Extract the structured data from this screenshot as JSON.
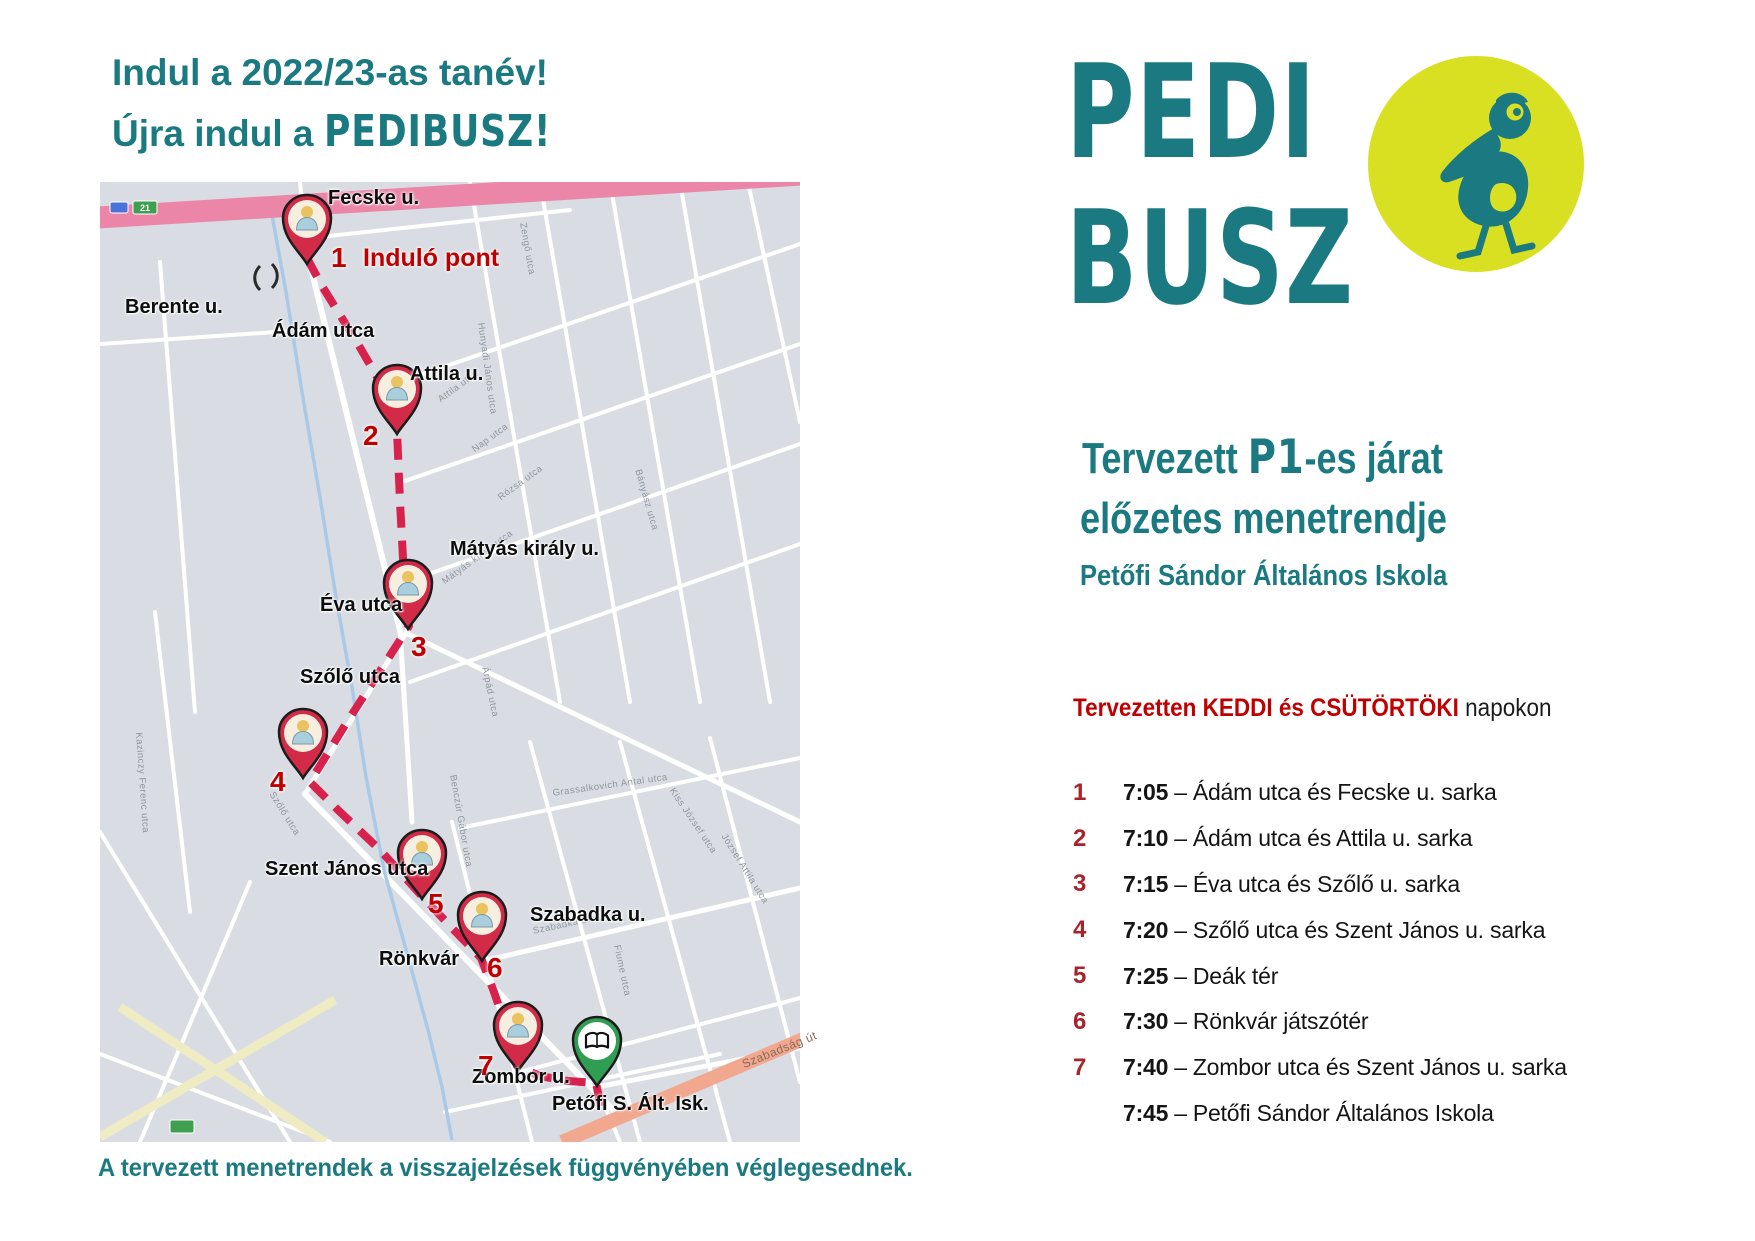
{
  "poster_title": {
    "line1": "Indul a 2022/23-as tanév!",
    "line2_prefix": "Újra indul a ",
    "line2_brand": "PEDIBUSZ!"
  },
  "logo": {
    "word1": "PEDI",
    "word2": "BUSZ",
    "badge_icon": "pelican-icon",
    "badge_bg": "#d9e021"
  },
  "plan": {
    "heading_pre": "Tervezett ",
    "heading_route": "P1",
    "heading_post": "-es járat",
    "heading_line2": "előzetes menetrendje",
    "school": "Petőfi Sándor Általános Iskola",
    "days_highlight": "Tervezetten KEDDI és CSÜTÖRTÖKI",
    "days_rest": " napokon"
  },
  "schedule": [
    {
      "n": "1",
      "time": "7:05",
      "place": "Ádám utca és Fecske u. sarka"
    },
    {
      "n": "2",
      "time": "7:10",
      "place": "Ádám utca és Attila u. sarka"
    },
    {
      "n": "3",
      "time": "7:15",
      "place": "Éva utca és Szőlő u. sarka"
    },
    {
      "n": "4",
      "time": "7:20",
      "place": "Szőlő utca és Szent János u. sarka"
    },
    {
      "n": "5",
      "time": "7:25",
      "place": "Deák tér"
    },
    {
      "n": "6",
      "time": "7:30",
      "place": "Rönkvár játszótér"
    },
    {
      "n": "7",
      "time": "7:40",
      "place": "Zombor utca és Szent János u. sarka"
    },
    {
      "n": "",
      "time": "7:45",
      "place": "Petőfi Sándor Általános Iskola"
    }
  ],
  "footer": "A tervezett menetrendek a visszajelzések függvényében véglegesednek.",
  "colors": {
    "teal": "#1b7a81",
    "red_text": "#c00000",
    "schedule_number_red": "#a92328",
    "route_red": "#d6224c",
    "pin_red": "#d22b47",
    "school_green": "#2f9e53",
    "map_bg": "#d9dde3",
    "street_white": "#ffffff",
    "creek_blue": "#a9c9e7",
    "major_road_pink": "#ec86a8",
    "major_road_salmon": "#f2a78f",
    "minor_road_yellow": "#efecc3",
    "faint_label_gray": "#8f959e"
  },
  "map": {
    "streets": [
      [
        205,
        62,
        300,
        448,
        6
      ],
      [
        300,
        448,
        312,
        640,
        5
      ],
      [
        309,
        446,
        205,
        612,
        5
      ],
      [
        205,
        612,
        520,
        935,
        6
      ],
      [
        497,
        905,
        700,
        866,
        5
      ],
      [
        497,
        905,
        520,
        960,
        4
      ],
      [
        210,
        56,
        470,
        28,
        4
      ],
      [
        0,
        162,
        205,
        148,
        4
      ],
      [
        207,
        64,
        200,
        0,
        4
      ],
      [
        370,
        0,
        460,
        520,
        4
      ],
      [
        440,
        0,
        530,
        520,
        4
      ],
      [
        510,
        0,
        600,
        520,
        4
      ],
      [
        580,
        0,
        670,
        520,
        4
      ],
      [
        648,
        0,
        700,
        240,
        4
      ],
      [
        300,
        200,
        700,
        62,
        4
      ],
      [
        302,
        300,
        700,
        162,
        4
      ],
      [
        306,
        400,
        700,
        262,
        4
      ],
      [
        310,
        500,
        700,
        362,
        4
      ],
      [
        308,
        452,
        700,
        640,
        5
      ],
      [
        430,
        560,
        540,
        960,
        4
      ],
      [
        520,
        560,
        630,
        960,
        4
      ],
      [
        610,
        556,
        700,
        900,
        4
      ],
      [
        352,
        640,
        432,
        960,
        4
      ],
      [
        360,
        646,
        700,
        576,
        4
      ],
      [
        383,
        779,
        700,
        706,
        5
      ],
      [
        420,
        890,
        700,
        816,
        4
      ],
      [
        345,
        930,
        620,
        872,
        4
      ],
      [
        60,
        80,
        95,
        530,
        4
      ],
      [
        55,
        430,
        90,
        730,
        4
      ],
      [
        0,
        650,
        190,
        960,
        4
      ],
      [
        0,
        872,
        230,
        960,
        4
      ],
      [
        150,
        700,
        40,
        960,
        4
      ]
    ],
    "yellow_roads": [
      [
        20,
        825,
        225,
        960
      ],
      [
        0,
        955,
        235,
        818
      ]
    ],
    "major_roads": [
      {
        "x1": -10,
        "y1": 36,
        "x2": 710,
        "y2": -8,
        "w": 22,
        "color_key": "major_road_pink"
      },
      {
        "x1": 462,
        "y1": 960,
        "x2": 715,
        "y2": 852,
        "w": 14,
        "color_key": "major_road_salmon"
      }
    ],
    "creek": [
      [
        170,
        22
      ],
      [
        186,
        110
      ],
      [
        202,
        210
      ],
      [
        220,
        315
      ],
      [
        236,
        415
      ],
      [
        252,
        505
      ],
      [
        266,
        595
      ],
      [
        284,
        688
      ],
      [
        308,
        775
      ],
      [
        328,
        848
      ],
      [
        342,
        905
      ],
      [
        352,
        958
      ]
    ],
    "route": [
      [
        207,
        76
      ],
      [
        222,
        104
      ],
      [
        258,
        162
      ],
      [
        288,
        214
      ],
      [
        297,
        248
      ],
      [
        300,
        320
      ],
      [
        304,
        395
      ],
      [
        309,
        444
      ],
      [
        282,
        486
      ],
      [
        247,
        540
      ],
      [
        210,
        600
      ],
      [
        238,
        628
      ],
      [
        280,
        668
      ],
      [
        320,
        712
      ],
      [
        352,
        746
      ],
      [
        381,
        776
      ],
      [
        394,
        810
      ],
      [
        407,
        848
      ],
      [
        417,
        884
      ],
      [
        440,
        894
      ],
      [
        468,
        899
      ],
      [
        496,
        901
      ],
      [
        502,
        930
      ]
    ],
    "shields": [
      {
        "x": 10,
        "y": 20,
        "w": 18,
        "h": 11,
        "color": "#4a72d8",
        "text": ""
      },
      {
        "x": 33,
        "y": 19,
        "w": 24,
        "h": 13,
        "color": "#3f9e4f",
        "text": "21"
      },
      {
        "x": 70,
        "y": 938,
        "w": 24,
        "h": 13,
        "color": "#3f9e4f",
        "text": ""
      }
    ],
    "stops": [
      {
        "n": "1",
        "x": 207,
        "y": 37
      },
      {
        "n": "2",
        "x": 297,
        "y": 207
      },
      {
        "n": "3",
        "x": 308,
        "y": 402
      },
      {
        "n": "4",
        "x": 203,
        "y": 551
      },
      {
        "n": "5",
        "x": 322,
        "y": 672
      },
      {
        "n": "6",
        "x": 382,
        "y": 734
      },
      {
        "n": "7",
        "x": 418,
        "y": 844
      }
    ],
    "school_pin": {
      "x": 497,
      "y": 859,
      "icon": "open-book-icon"
    },
    "street_labels": [
      {
        "text": "Fecske u.",
        "x": 228,
        "y": 5
      },
      {
        "text": "Berente u.",
        "x": 25,
        "y": 114
      },
      {
        "text": "Ádám utca",
        "x": 172,
        "y": 138
      },
      {
        "text": "Attila u.",
        "x": 310,
        "y": 181
      },
      {
        "text": "Mátyás király u.",
        "x": 350,
        "y": 356
      },
      {
        "text": "Éva utca",
        "x": 220,
        "y": 412
      },
      {
        "text": "Szőlő utca",
        "x": 200,
        "y": 484
      },
      {
        "text": "Szent János utca",
        "x": 165,
        "y": 676
      },
      {
        "text": "Szabadka u.",
        "x": 430,
        "y": 722
      },
      {
        "text": "Rönkvár",
        "x": 279,
        "y": 766
      },
      {
        "text": "Zombor u.",
        "x": 372,
        "y": 884
      },
      {
        "text": "Petőfi S. Ált. Isk.",
        "x": 452,
        "y": 911
      }
    ],
    "red_labels": [
      {
        "text": "1",
        "x": 231,
        "y": 60
      },
      {
        "text": "Induló pont",
        "x": 263,
        "y": 62,
        "size": 25
      },
      {
        "text": "2",
        "x": 263,
        "y": 238
      },
      {
        "text": "3",
        "x": 311,
        "y": 449
      },
      {
        "text": "4",
        "x": 170,
        "y": 584
      },
      {
        "text": "5",
        "x": 328,
        "y": 706
      },
      {
        "text": "6",
        "x": 387,
        "y": 770
      },
      {
        "text": "7",
        "x": 378,
        "y": 868
      }
    ],
    "faint_labels": [
      {
        "text": "Zengő utca",
        "x": 428,
        "y": 40,
        "rot": 80
      },
      {
        "text": "Hunyadi János utca",
        "x": 386,
        "y": 140,
        "rot": 82
      },
      {
        "text": "Attila utca",
        "x": 336,
        "y": 214,
        "rot": -36
      },
      {
        "text": "Nap utca",
        "x": 370,
        "y": 264,
        "rot": -36
      },
      {
        "text": "Rózsa utca",
        "x": 396,
        "y": 312,
        "rot": -36
      },
      {
        "text": "Mátyás király utca",
        "x": 340,
        "y": 396,
        "rot": -36
      },
      {
        "text": "Bányász utca",
        "x": 543,
        "y": 286,
        "rot": 74
      },
      {
        "text": "Árpád utca",
        "x": 390,
        "y": 484,
        "rot": 78
      },
      {
        "text": "Benczúr Gábor utca",
        "x": 358,
        "y": 592,
        "rot": 80
      },
      {
        "text": "Grassalkovich Antal utca",
        "x": 452,
        "y": 606,
        "rot": -8
      },
      {
        "text": "Kiss József utca",
        "x": 576,
        "y": 604,
        "rot": 56
      },
      {
        "text": "Szabadka utca",
        "x": 432,
        "y": 744,
        "rot": -12
      },
      {
        "text": "Fiume utca",
        "x": 522,
        "y": 762,
        "rot": 78
      },
      {
        "text": "Szőlő utca",
        "x": 176,
        "y": 608,
        "rot": 58
      },
      {
        "text": "Kazinczy Ferenc utca",
        "x": 44,
        "y": 550,
        "rot": 86
      },
      {
        "text": "József Attila utca",
        "x": 628,
        "y": 650,
        "rot": 58
      },
      {
        "text": "Szabadság út",
        "x": 640,
        "y": 876,
        "rot": -22,
        "size": 12,
        "c": "#8a6a58"
      }
    ]
  }
}
